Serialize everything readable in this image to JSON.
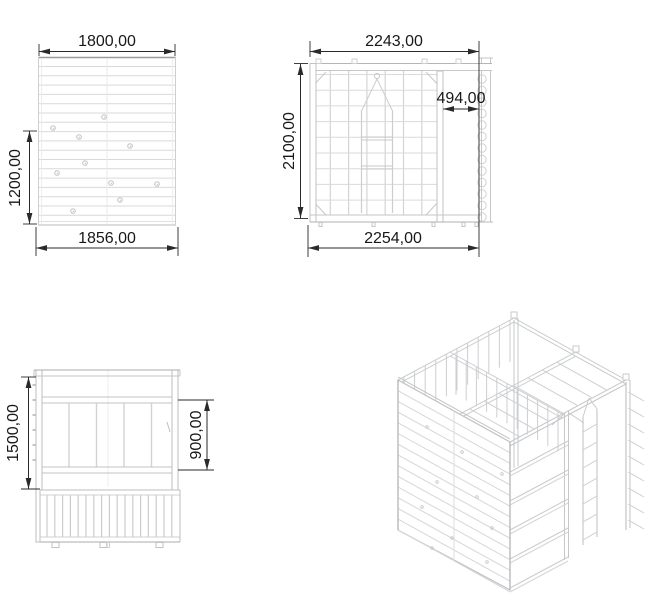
{
  "drawing": {
    "palette": {
      "background": "#ffffff",
      "dimension_lines": "#2a2a2a",
      "dimension_text": "#181818",
      "structure_light": "#d6d6d6",
      "structure_mid": "#bfbfbf"
    },
    "views": {
      "front_wall": {
        "dim_width_top": "1800,00",
        "dim_height_left": "1200,00",
        "dim_width_bottom": "1856,00"
      },
      "side": {
        "dim_width_top": "2243,00",
        "dim_height_left": "2100,00",
        "dim_width_inner": "494,00",
        "dim_width_bottom": "2254,00"
      },
      "front_lower": {
        "dim_height_left": "1500,00",
        "dim_height_right": "900,00"
      }
    }
  }
}
